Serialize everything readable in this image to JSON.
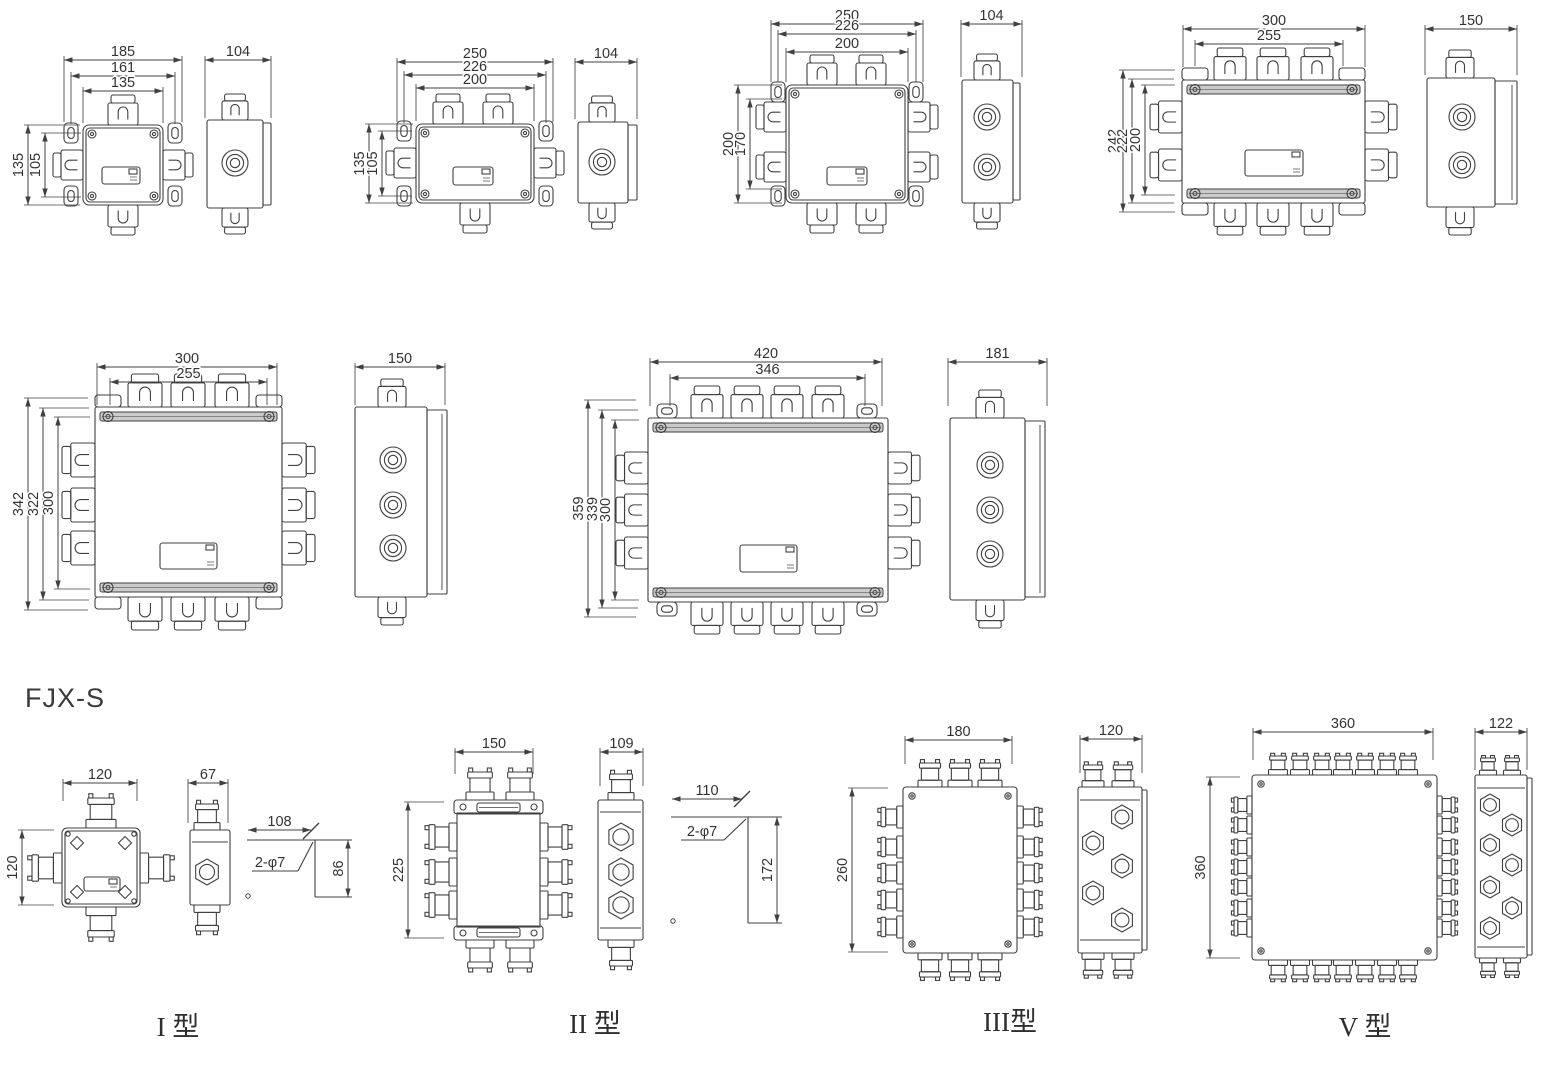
{
  "heading": "FJX-S",
  "colors": {
    "line": "#404040",
    "text": "#333333",
    "background": "#ffffff"
  },
  "drawings": {
    "d1": {
      "top_dims": [
        "185",
        "161",
        "135"
      ],
      "left_dims": [
        "135",
        "105"
      ],
      "side_width": "104"
    },
    "d2": {
      "top_dims": [
        "250",
        "226",
        "200"
      ],
      "left_dims": [
        "135",
        "105"
      ],
      "side_width": "104"
    },
    "d3": {
      "top_dims": [
        "250",
        "226",
        "200"
      ],
      "left_dims": [
        "200",
        "170"
      ],
      "side_width": "104"
    },
    "d4": {
      "top_dims": [
        "300",
        "255"
      ],
      "left_dims": [
        "242",
        "222",
        "200"
      ],
      "side_width": "150"
    },
    "d5": {
      "top_dims": [
        "300",
        "255"
      ],
      "left_dims": [
        "342",
        "322",
        "300"
      ],
      "side_width": "150"
    },
    "d6": {
      "top_dims": [
        "420",
        "346"
      ],
      "left_dims": [
        "359",
        "339",
        "300"
      ],
      "side_width": "181"
    },
    "t1": {
      "top_dims": [
        "120"
      ],
      "left_dims": [
        "120"
      ],
      "side_width": "67",
      "mount_width": "108",
      "mount_height": "86",
      "mount_holes": "2-φ7",
      "type_label": "I 型"
    },
    "t2": {
      "top_dims": [
        "150"
      ],
      "left_dims": [
        "225"
      ],
      "side_width": "109",
      "mount_width": "110",
      "mount_height": "172",
      "mount_holes": "2-φ7",
      "type_label": "II 型"
    },
    "t3": {
      "top_dims": [
        "180"
      ],
      "left_dims": [
        "260"
      ],
      "side_width": "120",
      "type_label": "III型"
    },
    "t4": {
      "top_dims": [
        "360"
      ],
      "left_dims": [
        "360"
      ],
      "side_width": "122",
      "type_label": "V 型"
    }
  }
}
